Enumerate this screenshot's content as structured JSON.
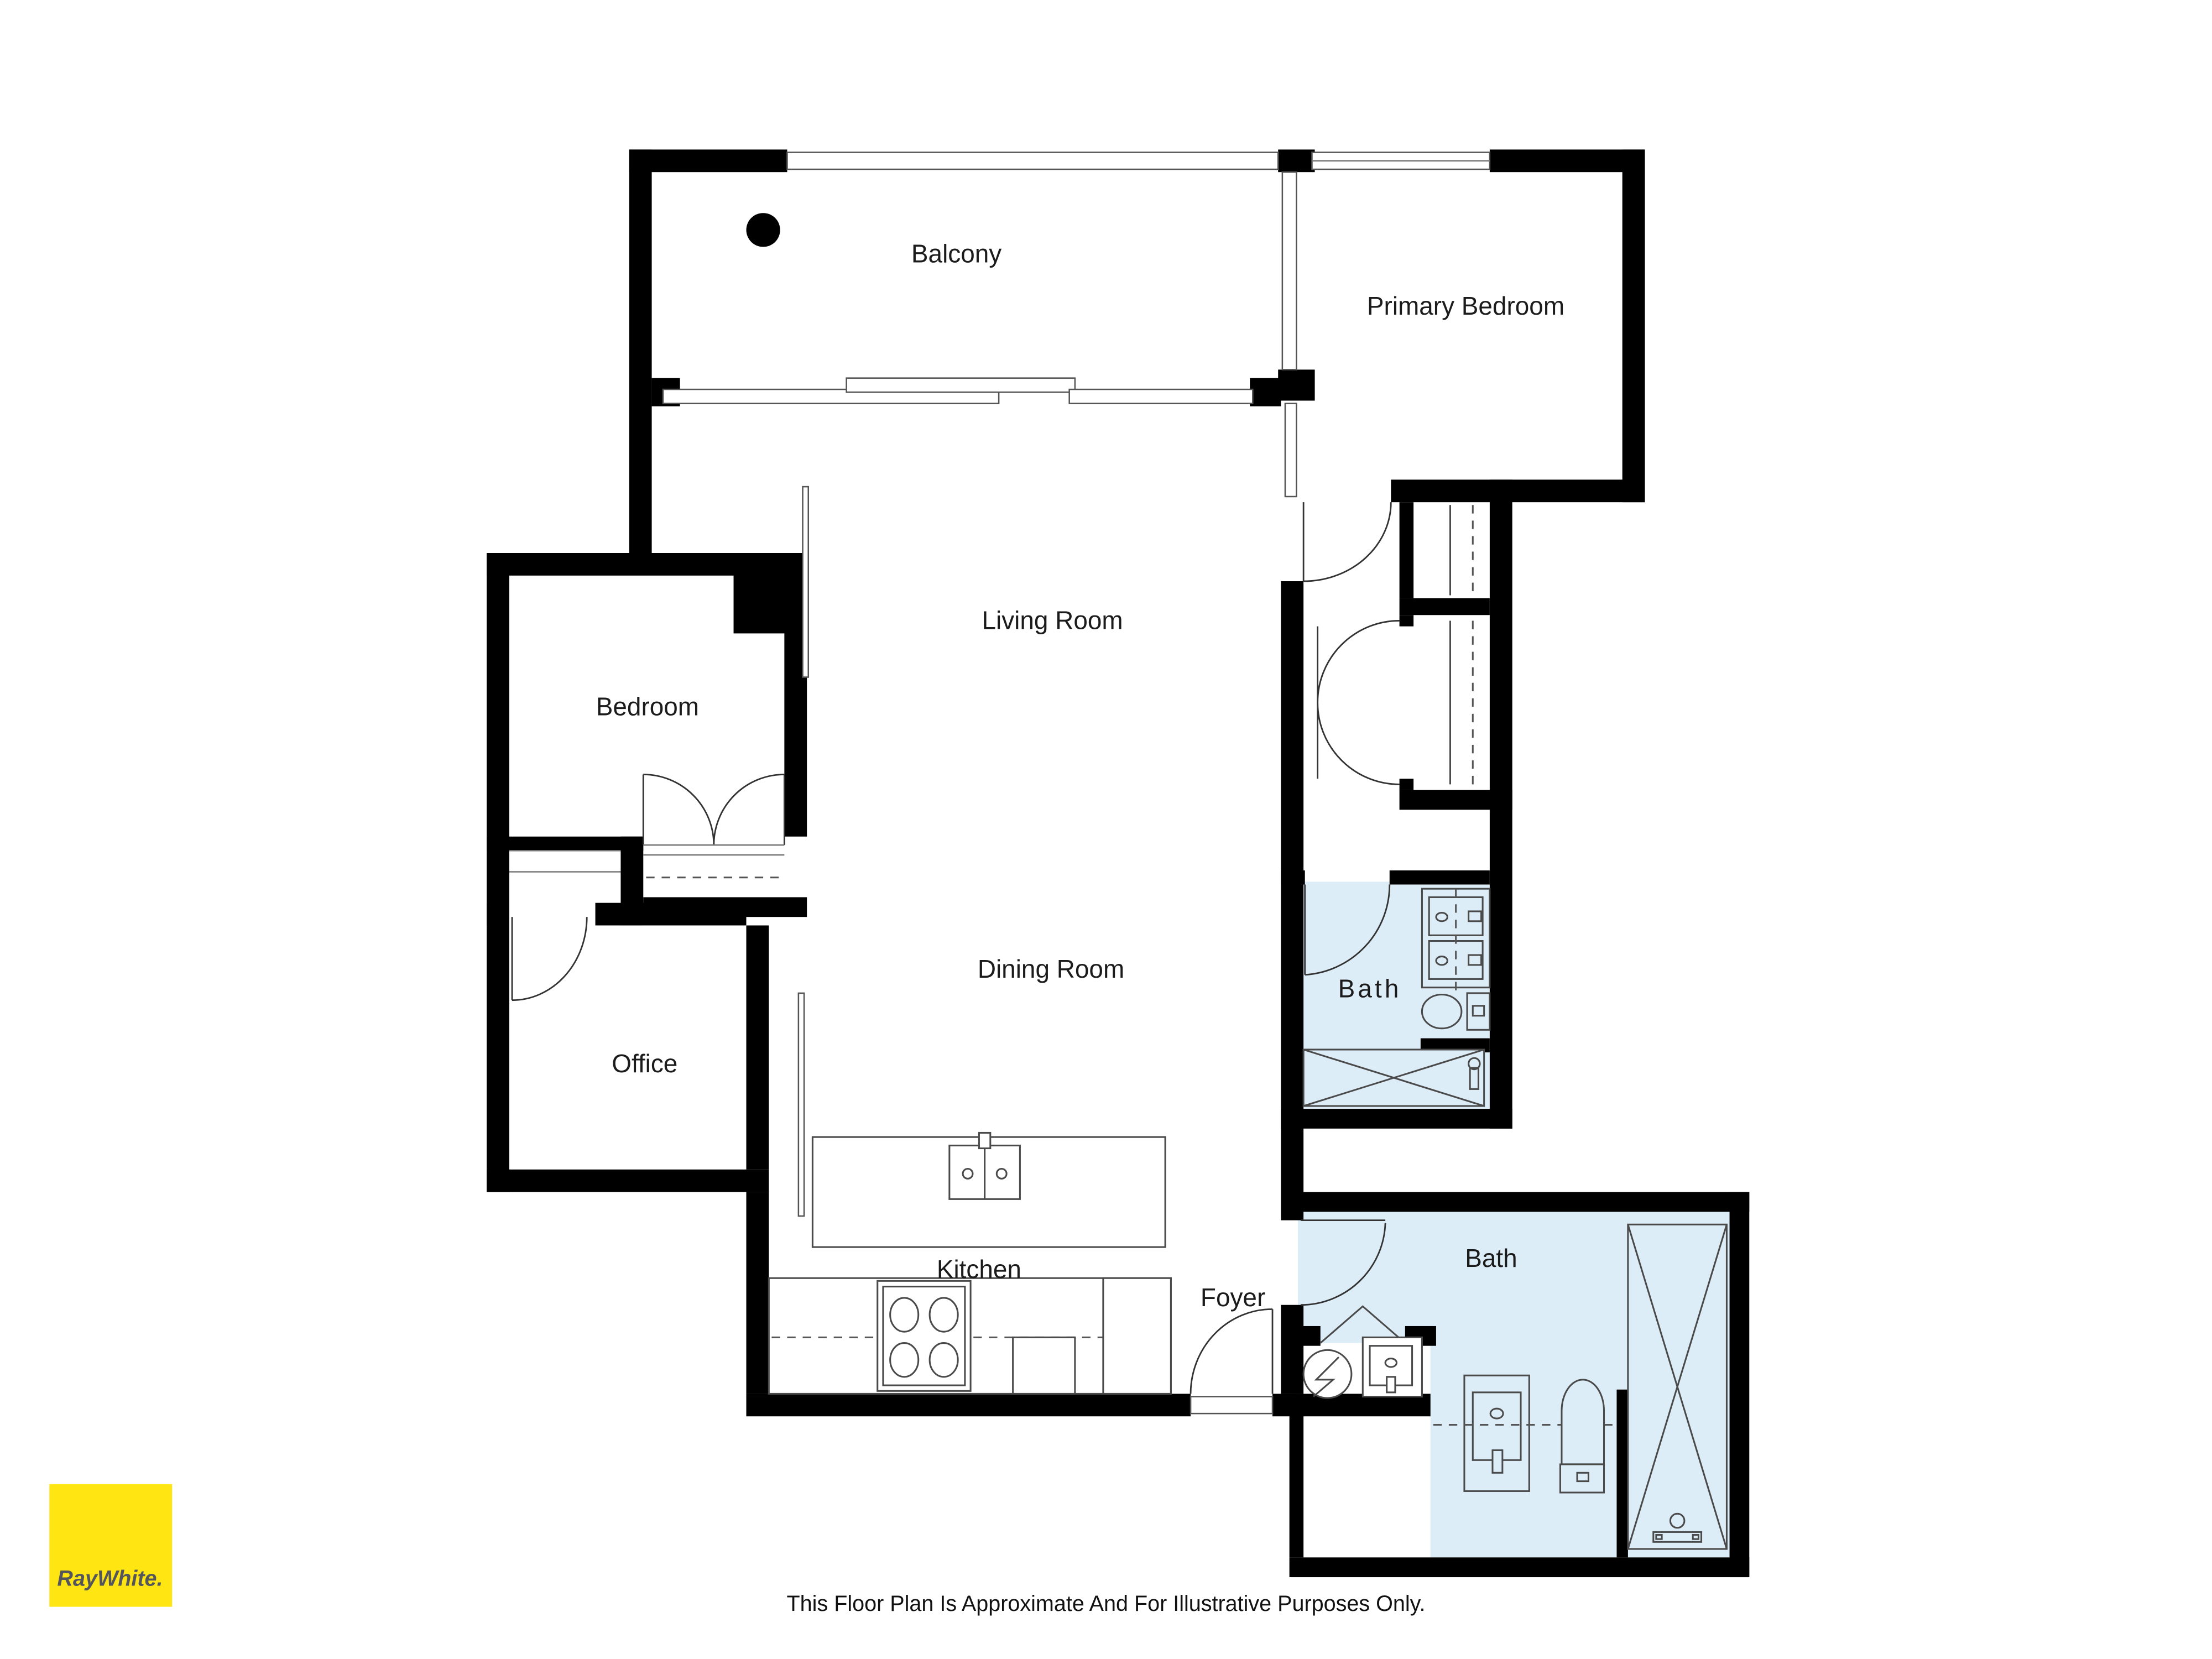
{
  "floorplan": {
    "rooms": {
      "balcony": "Balcony",
      "primary_bedroom": "Primary Bedroom",
      "living_room": "Living Room",
      "bedroom": "Bedroom",
      "dining_room": "Dining Room",
      "office": "Office",
      "bath_ensuite": "Bath",
      "kitchen": "Kitchen",
      "foyer": "Foyer",
      "bath_main": "Bath"
    },
    "colors": {
      "wall": "#000000",
      "bath_fill": "#ddedf8",
      "line": "#4a4a4a"
    }
  },
  "branding": {
    "agency_logo_text": "RayWhite.",
    "logo_background": "#ffe512",
    "logo_text_color": "#54565b"
  },
  "footer": {
    "disclaimer": "This Floor Plan Is Approximate And For Illustrative Purposes Only."
  }
}
